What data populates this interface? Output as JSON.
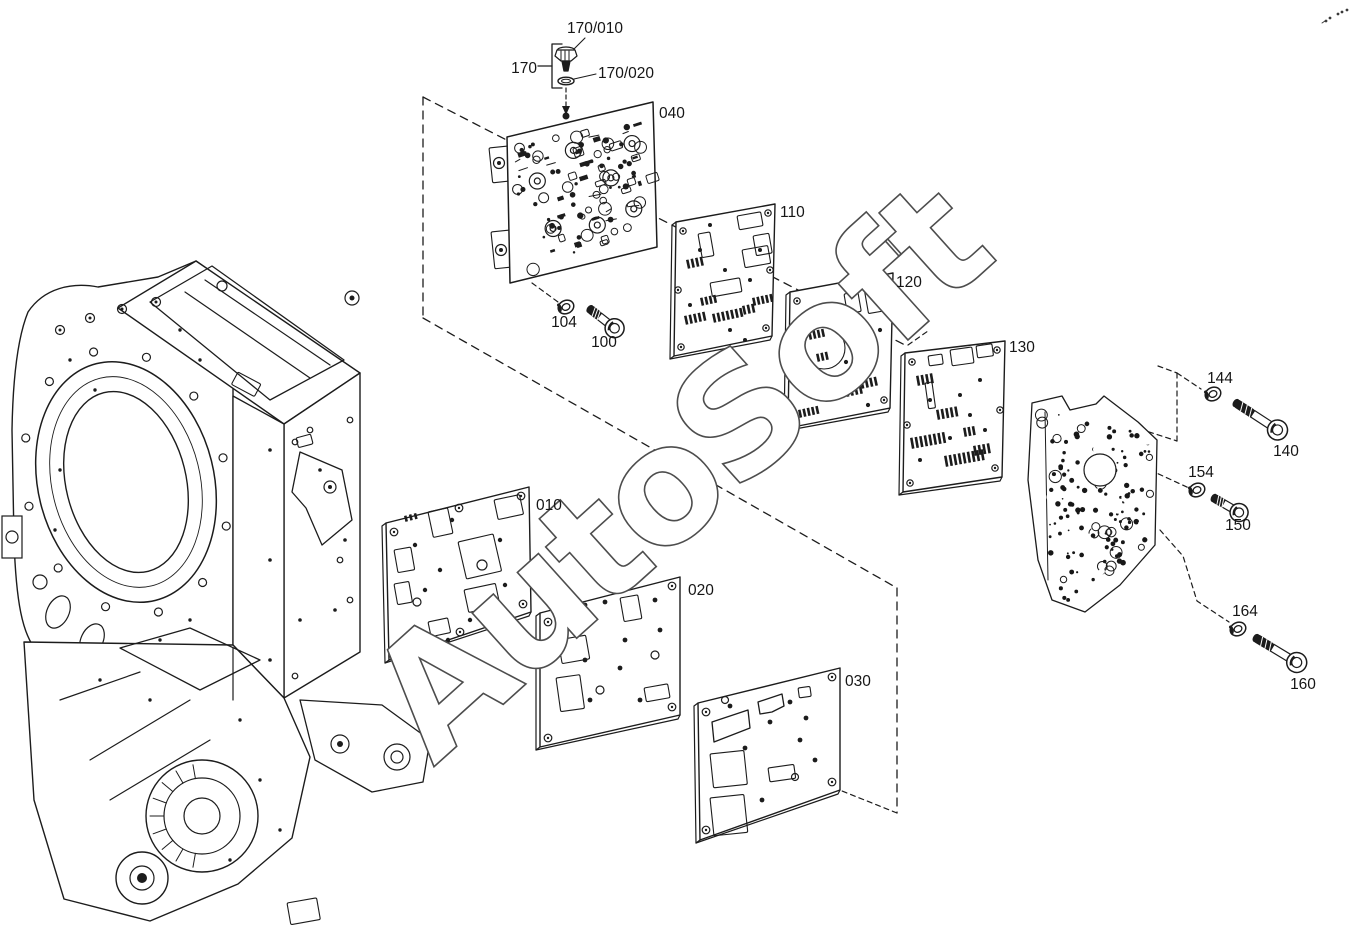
{
  "diagram": {
    "kind": "exploded-parts-diagram",
    "background": "#ffffff",
    "ink_color": "#1c1c1c",
    "watermark": "AutoSoft",
    "callouts": [
      {
        "ref": "170/010"
      },
      {
        "ref": "170"
      },
      {
        "ref": "170/020"
      },
      {
        "ref": "040"
      },
      {
        "ref": "110"
      },
      {
        "ref": "120"
      },
      {
        "ref": "104"
      },
      {
        "ref": "100"
      },
      {
        "ref": "130"
      },
      {
        "ref": "010"
      },
      {
        "ref": "020"
      },
      {
        "ref": "030"
      },
      {
        "ref": "144"
      },
      {
        "ref": "140"
      },
      {
        "ref": "154"
      },
      {
        "ref": "150"
      },
      {
        "ref": "164"
      },
      {
        "ref": "160"
      }
    ]
  }
}
